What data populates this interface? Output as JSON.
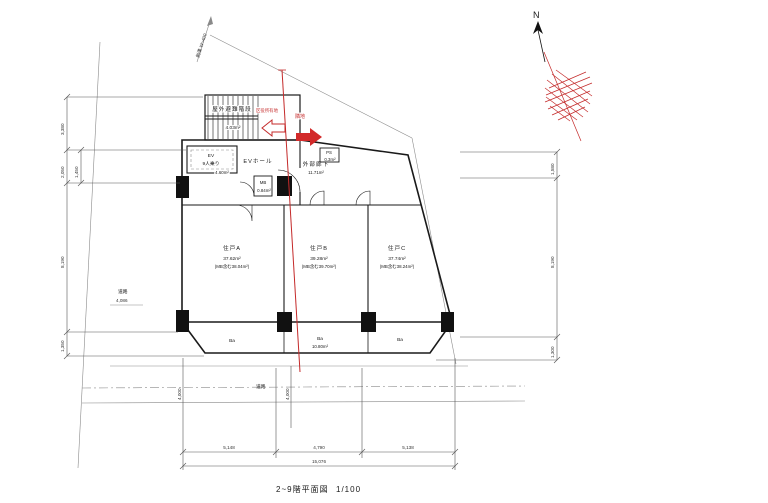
{
  "title": "2~9階平面図",
  "scale": "1/100",
  "north_label": "N",
  "boundary_note": "側溝 W=400",
  "red_labels": {
    "left_site": "区役所有地",
    "right_site": "隣地"
  },
  "rooms": {
    "stair": {
      "name": "屋外避難階段",
      "area": "4.03m²"
    },
    "elevator": {
      "name": "EV",
      "capacity": "9人乗り",
      "area": "4.60m²"
    },
    "ev_hall": {
      "name": "EVホール"
    },
    "corridor": {
      "name": "外部廊下",
      "area": "11.71m²"
    },
    "mb": {
      "name": "MB",
      "area": "0.84m²"
    },
    "ps": {
      "name": "PS",
      "area": "0.3m²"
    }
  },
  "units": [
    {
      "name": "住戸A",
      "area": "37.62m²",
      "area_note": "(MB含む38.04m²)"
    },
    {
      "name": "住戸B",
      "area": "39.28m²",
      "area_note": "(MB含む39.70m²)"
    },
    {
      "name": "住戸C",
      "area": "37.74m²",
      "area_note": "(MB含む38.24m²)"
    }
  ],
  "balcony": {
    "label": "Ba",
    "center_area": "10.80m²"
  },
  "roads": {
    "left_label": "道路",
    "left_width": "4,086",
    "bottom_label": "道路",
    "bottom_width": "4,000"
  },
  "dims": {
    "bottom_segments": [
      "5,148",
      "4,790",
      "5,138"
    ],
    "bottom_total": "15,076",
    "left_main": [
      "3,380",
      "2,050",
      "8,190",
      "1,350"
    ],
    "left_inner": "1,450",
    "right": [
      "1,580",
      "8,190",
      "1,300"
    ]
  }
}
